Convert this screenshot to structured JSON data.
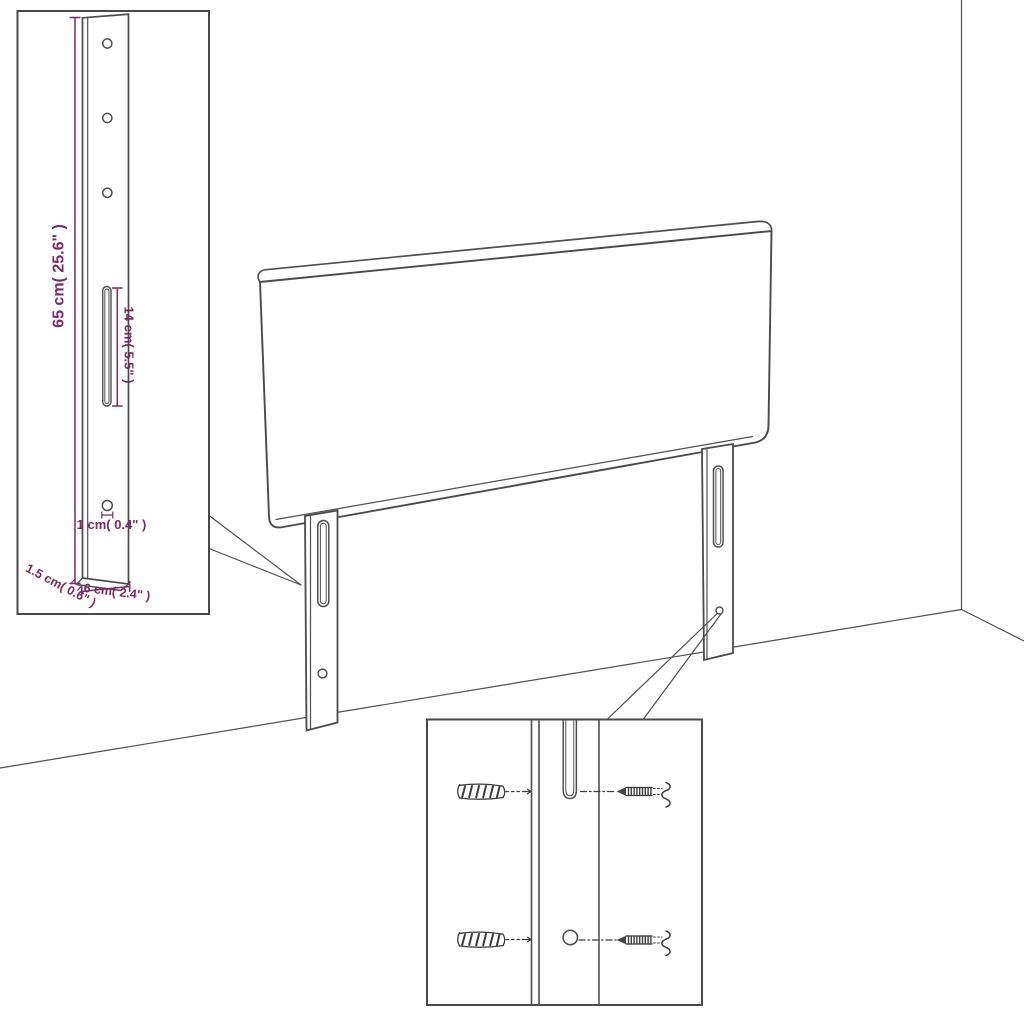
{
  "diagram": {
    "type": "assembly-dimension-diagram",
    "colors": {
      "background": "#ffffff",
      "line": "#4f4f4f",
      "dimension_text": "#7c2966"
    },
    "bracket_detail": {
      "height_label": "65 cm( 25.6\" )",
      "slot_height_label": "14 cm( 5.5\" )",
      "hole_diameter_label": "1 cm( 0.4\" )",
      "thickness_label": "1.5 cm( 0.6\" )",
      "width_label": "6 cm( 2.4\" )"
    }
  }
}
